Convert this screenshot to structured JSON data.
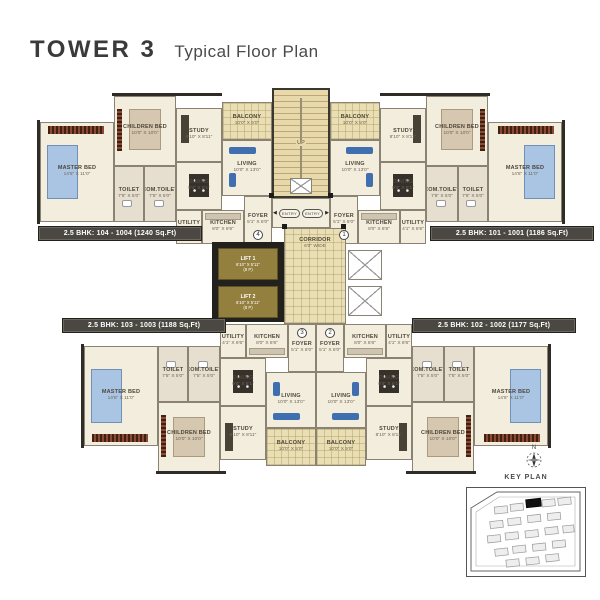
{
  "header": {
    "title": "TOWER 3",
    "subtitle": "Typical Floor Plan"
  },
  "units": [
    {
      "id": "104",
      "label": "2.5 BHK: 104 - 1004 (1240 Sq.Ft)",
      "number": "4"
    },
    {
      "id": "101",
      "label": "2.5 BHK: 101 - 1001 (1186 Sq.Ft)",
      "number": "1"
    },
    {
      "id": "103",
      "label": "2.5 BHK: 103 - 1003 (1188 Sq.Ft)",
      "number": "3"
    },
    {
      "id": "102",
      "label": "2.5 BHK: 102 - 1002 (1177 Sq.Ft)",
      "number": "2"
    }
  ],
  "rooms": {
    "master_bed": {
      "name": "MASTER BED",
      "dims": "14'5\" X 11'0\""
    },
    "children_bed": {
      "name": "CHILDREN BED",
      "dims": "10'0\" X 10'0\""
    },
    "study": {
      "name": "STUDY",
      "dims": "8'10\" X 8'11\""
    },
    "living": {
      "name": "LIVING",
      "dims": "10'0\" X 13'0\""
    },
    "dining": {
      "name": "DINING",
      "dims": "9'4\" X 8'1\""
    },
    "kitchen": {
      "name": "KITCHEN",
      "dims": "8'0\" X 8'6\""
    },
    "utility": {
      "name": "UTILITY",
      "dims": "4'1\" X 8'6\""
    },
    "toilet": {
      "name": "TOILET",
      "dims": "7'5\" X 5'0\""
    },
    "com_toilet": {
      "name": "COM.TOILET",
      "dims": "7'5\" X 5'0\""
    },
    "foyer": {
      "name": "FOYER",
      "dims": "5'1\" X 8'0\""
    },
    "balcony": {
      "name": "BALCONY",
      "dims": "10'0\" X 5'0\""
    }
  },
  "core": {
    "lift1": {
      "name": "LIFT 1",
      "dims": "6'10\" X 5'11\"",
      "cap": "(8 P)"
    },
    "lift2": {
      "name": "LIFT 2",
      "dims": "6'10\" X 5'11\"",
      "cap": "(8 P)"
    },
    "corridor": {
      "name": "CORRIDOR",
      "dims": "6'0\" WIDE"
    },
    "stair_up": "UP",
    "entry": "ENTRY"
  },
  "key_plan": {
    "label": "KEY PLAN",
    "north": "N"
  },
  "colors": {
    "accent_dark": "#4b4843",
    "floor": "#f3eddd",
    "balcony": "#eadfb4",
    "lift": "#93803f"
  }
}
